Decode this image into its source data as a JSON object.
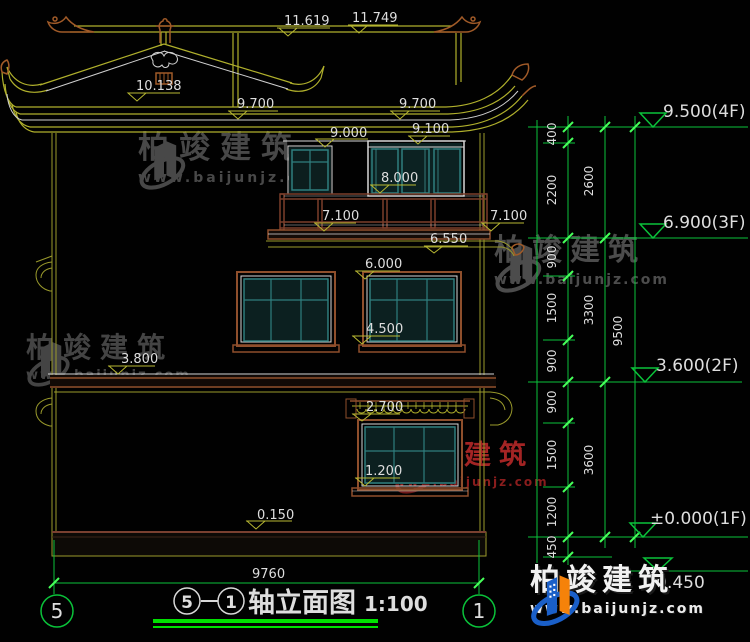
{
  "drawing": {
    "title": {
      "circle_a": "5",
      "circle_b": "1",
      "name": "轴立面图",
      "scale": "1:100"
    },
    "axis_bubbles": {
      "left": "5",
      "right": "1"
    },
    "overall_width": "9760",
    "level_labels": {
      "ridge_top": "11.749",
      "ridge": "11.619",
      "gable": "10.138",
      "eave_left": "9.700",
      "eave_right": "9.700",
      "win4_left": "9.000",
      "win4_right": "9.100",
      "balcony_rail": "8.000",
      "balcony_floor_left": "7.100",
      "balcony_floor_right": "7.100",
      "eave3_bottom": "6.550",
      "win3_top": "6.000",
      "win3_sill": "4.500",
      "floor2_band": "3.800",
      "canopy": "2.700",
      "win1_sill": "1.200",
      "plinth": "0.150"
    },
    "right_dims": {
      "col1": [
        "400",
        "2200",
        "900",
        "1500",
        "900",
        "900",
        "1500",
        "1200",
        "450"
      ],
      "col2": [
        "2600",
        "3300",
        "3600"
      ],
      "col3": [
        "9500"
      ]
    },
    "elevation_marks": [
      "9.500(4F)",
      "6.900(3F)",
      "3.600(2F)",
      "±0.000(1F)"
    ],
    "elevation_hidden": "-0.450"
  },
  "watermark": {
    "brand": "柏竣建筑",
    "url": "www.baijunjz.com"
  },
  "colors": {
    "dim_green": "#0ac23a",
    "line_olive": "#b0b02c",
    "frame_brown": "#8f4f2c",
    "window_teal": "#2f7e7e",
    "logo_blue": "#1a5fc8",
    "logo_orange": "#f5820a"
  }
}
